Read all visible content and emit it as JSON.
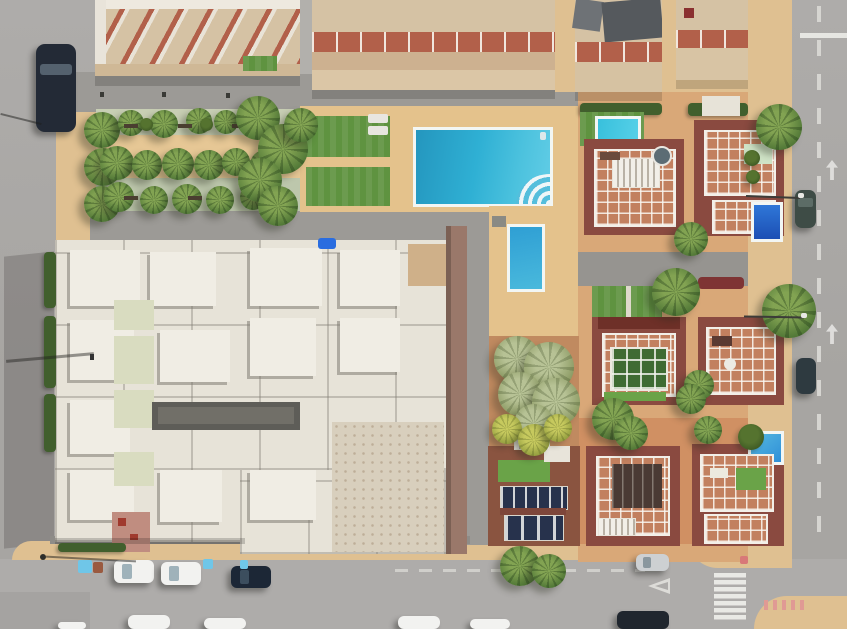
{
  "meta": {
    "description": "Top-down aerial drone photograph of a Mediterranean residential neighborhood: a row of apartment blocks at top, a landscaped palm garden, a communal pool area with two turquoise pools, a large white flat-roofed apartment complex at lower left, three rows of terracotta-roofed villas with private pools at right, and grey streets with parked cars, a pedestrian crossing and a traffic island",
    "scene_type": "aerial-photo",
    "width": 847,
    "height": 629
  },
  "palette": {
    "road": "#a7a5a2",
    "road-light": "#aeacaa",
    "sand": "#dfc091",
    "sand2": "#e6c795",
    "deck": "#e4c28c",
    "villa-ground": "#d9a878",
    "villa-patio": "#d09063",
    "walkway": "#9c9a96",
    "walkway-dark": "#8e8c88",
    "lawn": "#5f9340",
    "turf": "#6aa348",
    "sage": "#c8cfb4",
    "sage2": "#bdc7ac",
    "hedge": "#415f2d",
    "palm-light": "#82a352",
    "palm-dark": "#4c7334",
    "pool-main": "#2aa8cf",
    "pool-small": "#2f9fd4",
    "building-white": "#e7e3d8",
    "building-white2": "#f0ede4",
    "building-beige": "#d8cfbd",
    "right-wall": "#9a786a",
    "courtyard": "#5e5d58",
    "skylight": "#d9dcc0",
    "roof-tile": "#b2604a",
    "roof-beige": "#d5c2a4",
    "villa-wall": "#8a4a40",
    "villa-terrace": "#c2805f",
    "railing": "#f2efe8",
    "solar": "#27324c",
    "conservatory": "#3f6b33",
    "car-white": "#f2f2f0",
    "car-dark": "#232a36",
    "car-silver": "#cdd0d2",
    "car-green": "#3e4c46",
    "marking": "#e6e6e2",
    "bin-blue": "#6fc6e8",
    "pink": "#e09a94"
  },
  "inventory": {
    "streets": [
      "left residential street",
      "bottom street with parallel-parked cars",
      "right street with dashed center line and lane arrows"
    ],
    "road_markings": [
      "pedestrian crossing with 7 white stripes",
      "yield triangle",
      "dashed center lines",
      "2 white direction arrows",
      "stop line at top right",
      "pink kerb hatching on traffic island"
    ],
    "buildings": {
      "apartment_row_top": "4 beige blocks with terracotta roof bands and white balcony railings",
      "white_complex": "large white flat-roofed apartment complex with roof units, pale-green skylight strips, dark inner courtyard, beige wing and pink entrance",
      "villas": "8 detached villas with maroon walls, tiled roof terraces and white railings",
      "villa_features": [
        "white pergola slats",
        "green conservatory",
        "two dark solar/glass panel arrays",
        "round jacuzzi",
        "white canopy",
        "satellite dish"
      ]
    },
    "pools": [
      {
        "name": "communal-pool-large",
        "shape": "rectangular",
        "water": "turquoise",
        "detail": "corner steps with white/blue fan stripes"
      },
      {
        "name": "communal-pool-small",
        "shape": "rectangular",
        "water": "blue"
      },
      {
        "name": "villa-pool-row1-left",
        "water": "turquoise"
      },
      {
        "name": "villa-pool-row1-right",
        "water": "deep blue"
      },
      {
        "name": "villa-pool-row3-right",
        "water": "blue"
      }
    ],
    "vegetation": {
      "palm_trees": "approx. 40 palms in garden rows, villa gardens and overhanging streets",
      "lawns": "6+ green lawns and artificial turf patches",
      "garden": "3 planting bands (sage/sand/sage) with shrubs and benches",
      "other": "dark hedges, bougainvillea strip"
    },
    "vehicles": [
      "dark van parked on left street",
      "2 white cars and 1 dark blue car parked on bottom street",
      "silver car driving near crossing",
      "2 dark cars parked on right street",
      "5 partially visible cars at bottom edge",
      "light-blue and brown containers on kerb"
    ],
    "street_furniture": [
      "street lights with long shadows",
      "garden benches",
      "pool loungers"
    ]
  }
}
